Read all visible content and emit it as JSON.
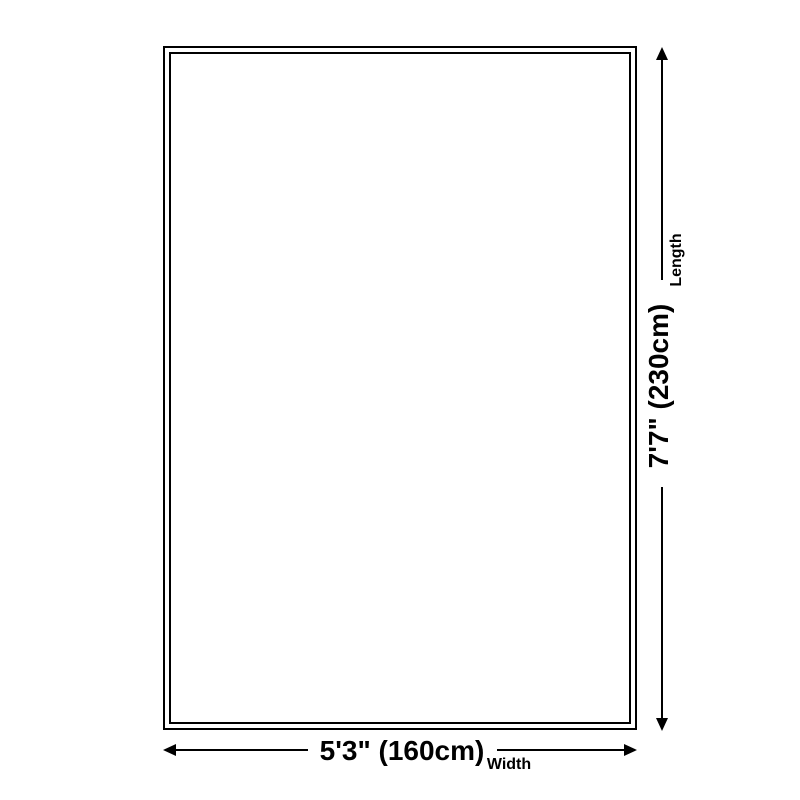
{
  "diagram": {
    "length": {
      "value": "7'7\" (230cm)",
      "label": "Length"
    },
    "width": {
      "value": "5'3\" (160cm)",
      "label": "Width"
    },
    "colors": {
      "line": "#000000",
      "text": "#000000",
      "background": "#ffffff"
    }
  }
}
